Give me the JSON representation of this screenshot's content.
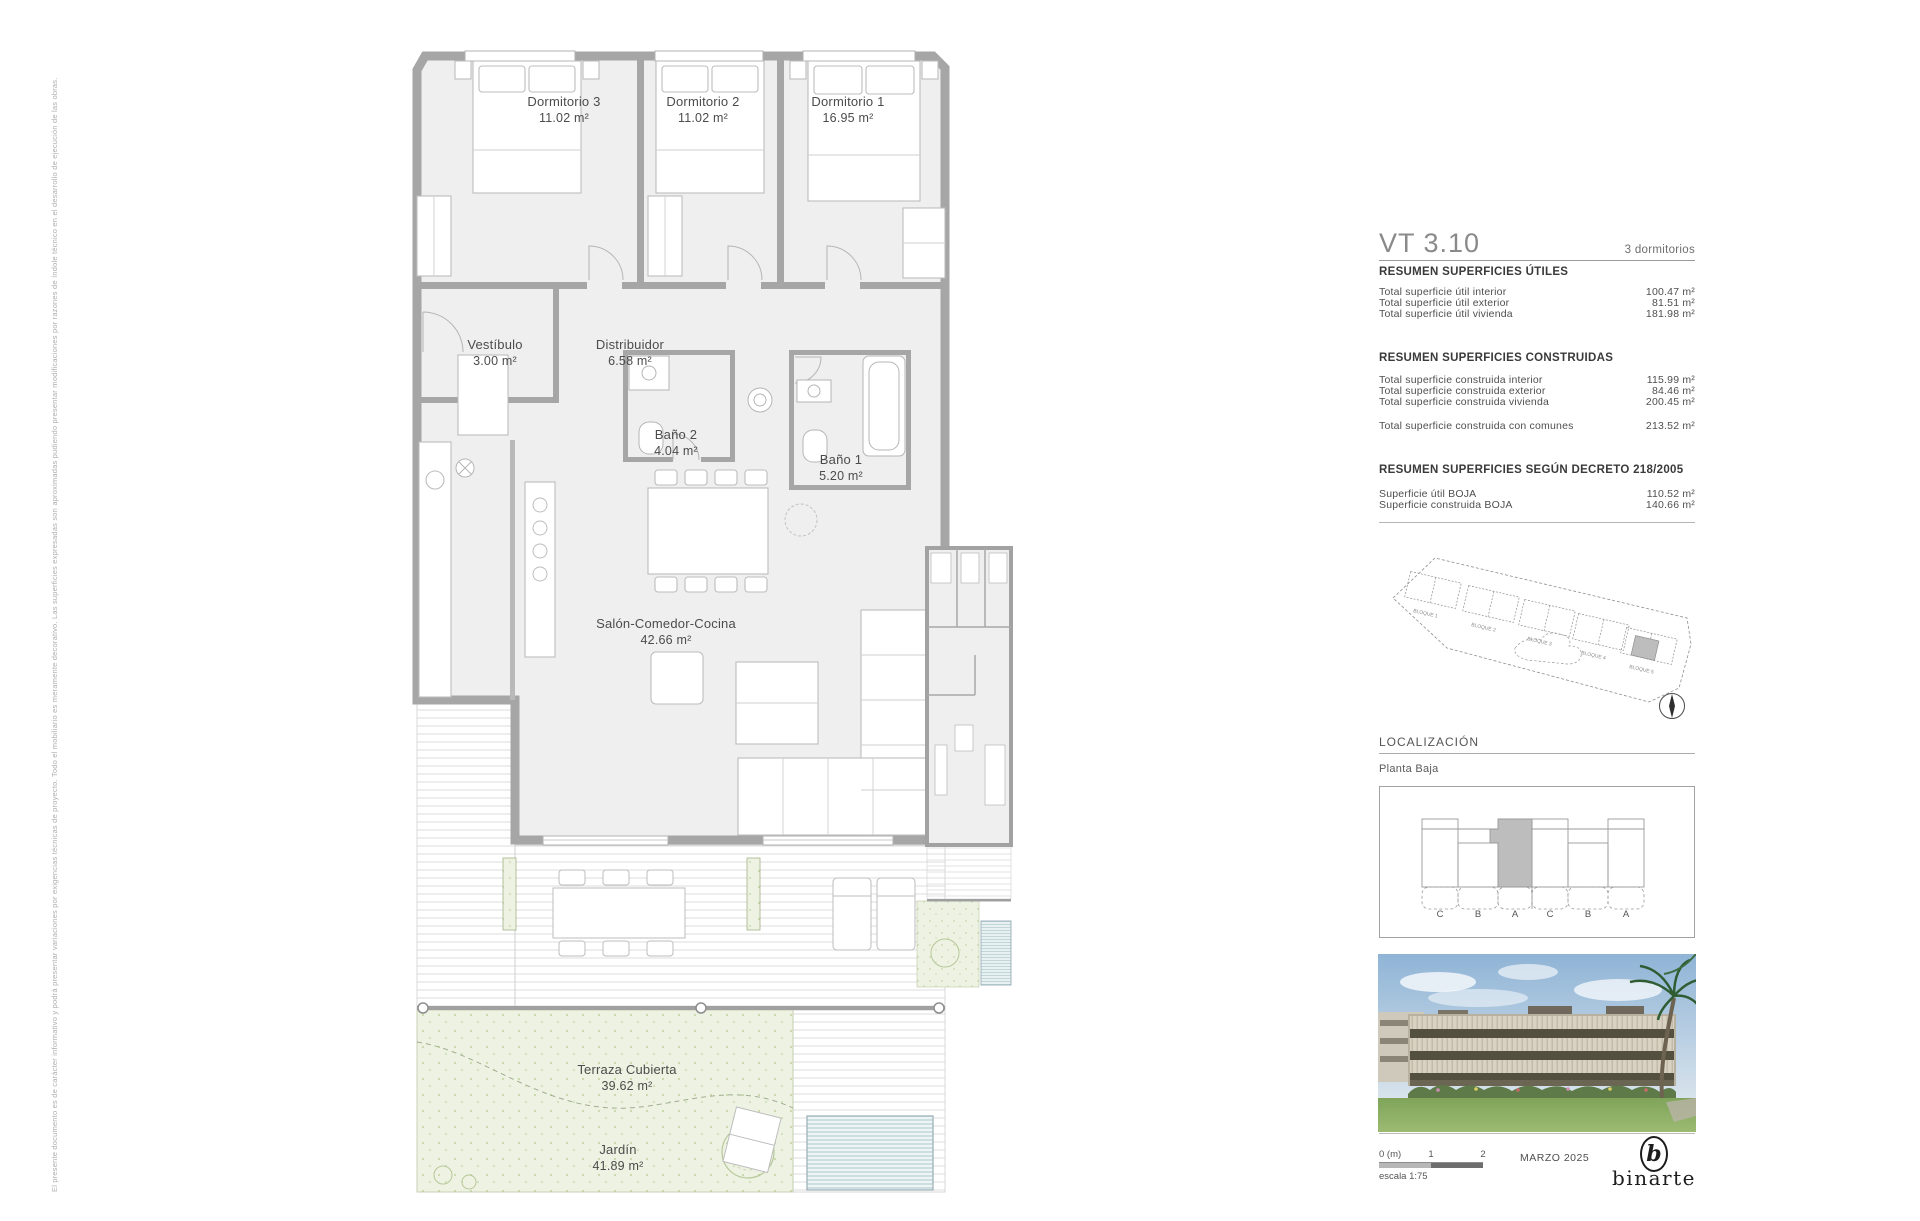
{
  "disclaimer": "El presente documento es de carácter informativo y podrá presentar variaciones por exigencias técnicas de proyecto. Todo el mobiliario es meramente decorativo. Las superficies expresadas son aproximadas pudiendo presentar modificaciones por razones de índole técnico en el desarrollo de ejecución de las obras.",
  "plan": {
    "rooms": [
      {
        "name": "Dormitorio 3",
        "area": "11.02 m²"
      },
      {
        "name": "Dormitorio 2",
        "area": "11.02 m²"
      },
      {
        "name": "Dormitorio 1",
        "area": "16.95 m²"
      },
      {
        "name": "Vestíbulo",
        "area": "3.00 m²"
      },
      {
        "name": "Distribuidor",
        "area": "6.58 m²"
      },
      {
        "name": "Baño 2",
        "area": "4.04 m²"
      },
      {
        "name": "Baño 1",
        "area": "5.20 m²"
      },
      {
        "name": "Salón-Comedor-Cocina",
        "area": "42.66 m²"
      },
      {
        "name": "Terraza Cubierta",
        "area": "39.62 m²"
      },
      {
        "name": "Jardín",
        "area": "41.89 m²"
      }
    ]
  },
  "panel": {
    "unit_code": "VT 3.10",
    "unit_type": "3 dormitorios",
    "utiles": {
      "title": "RESUMEN SUPERFICIES ÚTILES",
      "rows": [
        {
          "label": "Total superficie útil interior",
          "value": "100.47 m²"
        },
        {
          "label": "Total superficie útil exterior",
          "value": "81.51 m²"
        },
        {
          "label": "Total superficie útil vivienda",
          "value": "181.98 m²"
        }
      ]
    },
    "construidas": {
      "title": "RESUMEN SUPERFICIES CONSTRUIDAS",
      "rows": [
        {
          "label": "Total superficie construida interior",
          "value": "115.99 m²"
        },
        {
          "label": "Total superficie construida exterior",
          "value": "84.46 m²"
        },
        {
          "label": "Total superficie construida vivienda",
          "value": "200.45 m²"
        }
      ],
      "extra": {
        "label": "Total superficie construida con comunes",
        "value": "213.52 m²"
      }
    },
    "decreto": {
      "title": "RESUMEN SUPERFICIES SEGÚN DECRETO 218/2005",
      "rows": [
        {
          "label": "Superficie útil BOJA",
          "value": "110.52 m²"
        },
        {
          "label": "Superficie construida BOJA",
          "value": "140.66 m²"
        }
      ]
    },
    "siteplan_blocks": [
      "BLOQUE 1",
      "BLOQUE 2",
      "BLOQUE 3",
      "BLOQUE 4",
      "BLOQUE 5"
    ],
    "localizacion": {
      "title": "LOCALIZACIÓN",
      "subtitle": "Planta Baja",
      "units": [
        "C",
        "B",
        "A",
        "C",
        "B",
        "A"
      ]
    }
  },
  "footer": {
    "scale_marks": [
      "0 (m)",
      "1",
      "2"
    ],
    "scale_label": "escala 1:75",
    "date": "MARZO 2025",
    "logo": "binarte"
  },
  "colors": {
    "wall": "#a6a6a6",
    "room_fill": "#efeff0",
    "garden": "#edf2e2",
    "highlight": "#bdbdbd",
    "pool": "#cddee4"
  }
}
